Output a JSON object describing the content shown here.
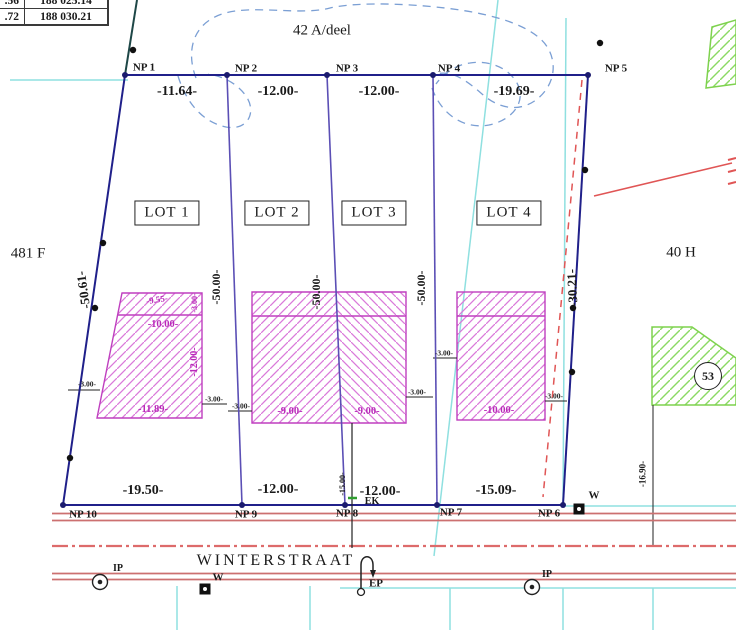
{
  "table": {
    "rows": [
      [
        ".56",
        "188 025.14"
      ],
      [
        ".72",
        "188 030.21"
      ]
    ]
  },
  "parcels": {
    "top": "42 A/deel",
    "left": "481 F",
    "right": "40 H",
    "circle": "53"
  },
  "street": {
    "name": "WINTERSTRAAT"
  },
  "lots": [
    "LOT 1",
    "LOT 2",
    "LOT 3",
    "LOT 4"
  ],
  "nps": [
    "NP 1",
    "NP 2",
    "NP 3",
    "NP 4",
    "NP 5",
    "NP 6",
    "NP 7",
    "NP 8",
    "NP 9",
    "NP 10"
  ],
  "dims": {
    "top": [
      "-11.64-",
      "-12.00-",
      "-12.00-",
      "-19.69-"
    ],
    "bottom": [
      "-19.50-",
      "-12.00-",
      "-12.00-",
      "-15.09-"
    ],
    "left_boundary": "-50.61-",
    "right_boundary": "-30.21-",
    "right_offset": "-16.90-",
    "lot_depths": [
      "-50.00-",
      "-50.00-",
      "-50.00-"
    ],
    "service_line": "-15.00-",
    "b1_top": "-9.55-",
    "b1_strip": "-3.00-",
    "b1_width": "-10.00-",
    "b1_depth": "-12.00-",
    "b1_bottom": "-11.89-",
    "b2_left": "-9.00-",
    "b2_right": "-9.00-",
    "b4_bottom": "-10.00-",
    "off1": "-3.00-",
    "off2": "-3.00-",
    "off3": "-3.00-",
    "off4": "-3.00-",
    "off5": "-3.00-",
    "off6": "-3.00-"
  },
  "markers": {
    "ek": "EK",
    "ep": "EP",
    "w1": "W",
    "w2": "W",
    "ip1": "IP",
    "ip2": "IP"
  },
  "colors": {
    "boundary": "#20208a",
    "lot_line": "#5b4fb5",
    "building_edge": "#bf3fbf",
    "building_hatch": "#da7ada",
    "green": "#7ed24e",
    "street_red": "#cc7070",
    "centerline_red": "#dd6b6b",
    "cyan": "#8fe0e0",
    "contour_blue": "#7b9fd4",
    "magenta_text": "#b92ab9",
    "red_dashed": "#e05555"
  }
}
